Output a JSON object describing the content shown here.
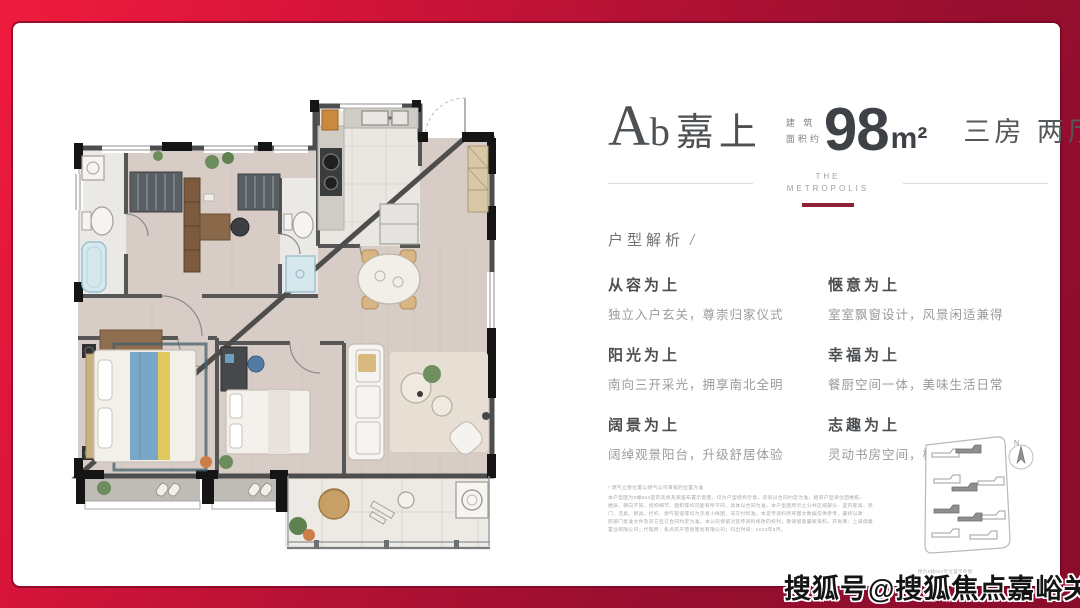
{
  "header": {
    "name_initial": "A",
    "name_sub": "b",
    "name_cn": "嘉上",
    "area_label_line1": "建 筑",
    "area_label_line2": "面积约",
    "area_value": "98",
    "area_unit": "m²",
    "rooms": "三房 两厅 两卫",
    "brand_line1": "THE",
    "brand_line2": "METROPOLIS"
  },
  "section": {
    "title": "户型解析",
    "slash": "/"
  },
  "features": [
    {
      "title": "从容为上",
      "desc": "独立入户玄关，尊崇归家仪式"
    },
    {
      "title": "惬意为上",
      "desc": "室室飘窗设计，风景闲适兼得"
    },
    {
      "title": "阳光为上",
      "desc": "南向三开采光，拥享南北全明"
    },
    {
      "title": "幸福为上",
      "desc": "餐厨空间一体，美味生活日常"
    },
    {
      "title": "阔景为上",
      "desc": "阔绰观景阳台，升级舒居体验"
    },
    {
      "title": "志趣为上",
      "desc": "灵动书房空间，栖憩志趣理想"
    }
  ],
  "disclaimer": {
    "note": "* 燃气立管位置以燃气公司审核的位置为准",
    "lines": [
      "本户型图为6幢504室的装修及家居布置示意图，仅为户型结构示意，房间以合同约定为准，相同户型单位因楼栋、",
      "楼层、朝向不同，结构细节、面积等均可能有所不同，具体以合同为准。本户型图所示之公共区域部分、室内家具、移",
      "门、洁具、厨具、栏杆、燃气管道等均为示意小样图，非交付标准，本宣传资料所有图文数据仅供参考，最终以政",
      "府部门批准文件及双方签订合同约定为准。本公司保留对宣传资料修改的权利，敬请留意最新资料。开发商：上海保集",
      "置业有限公司；代理商：焦点房产营销策划有限公司；刊出时间：2023年6月。"
    ]
  },
  "sitemap": {
    "north_label": "N",
    "caption": "图示6幢504室位置示意图"
  },
  "watermark": "搜狐号@搜狐焦点嘉峪关站",
  "colors": {
    "accent_bar": "#8e2136",
    "border_red_light": "#f01c3e",
    "border_red_dark": "#8a0c2b"
  }
}
